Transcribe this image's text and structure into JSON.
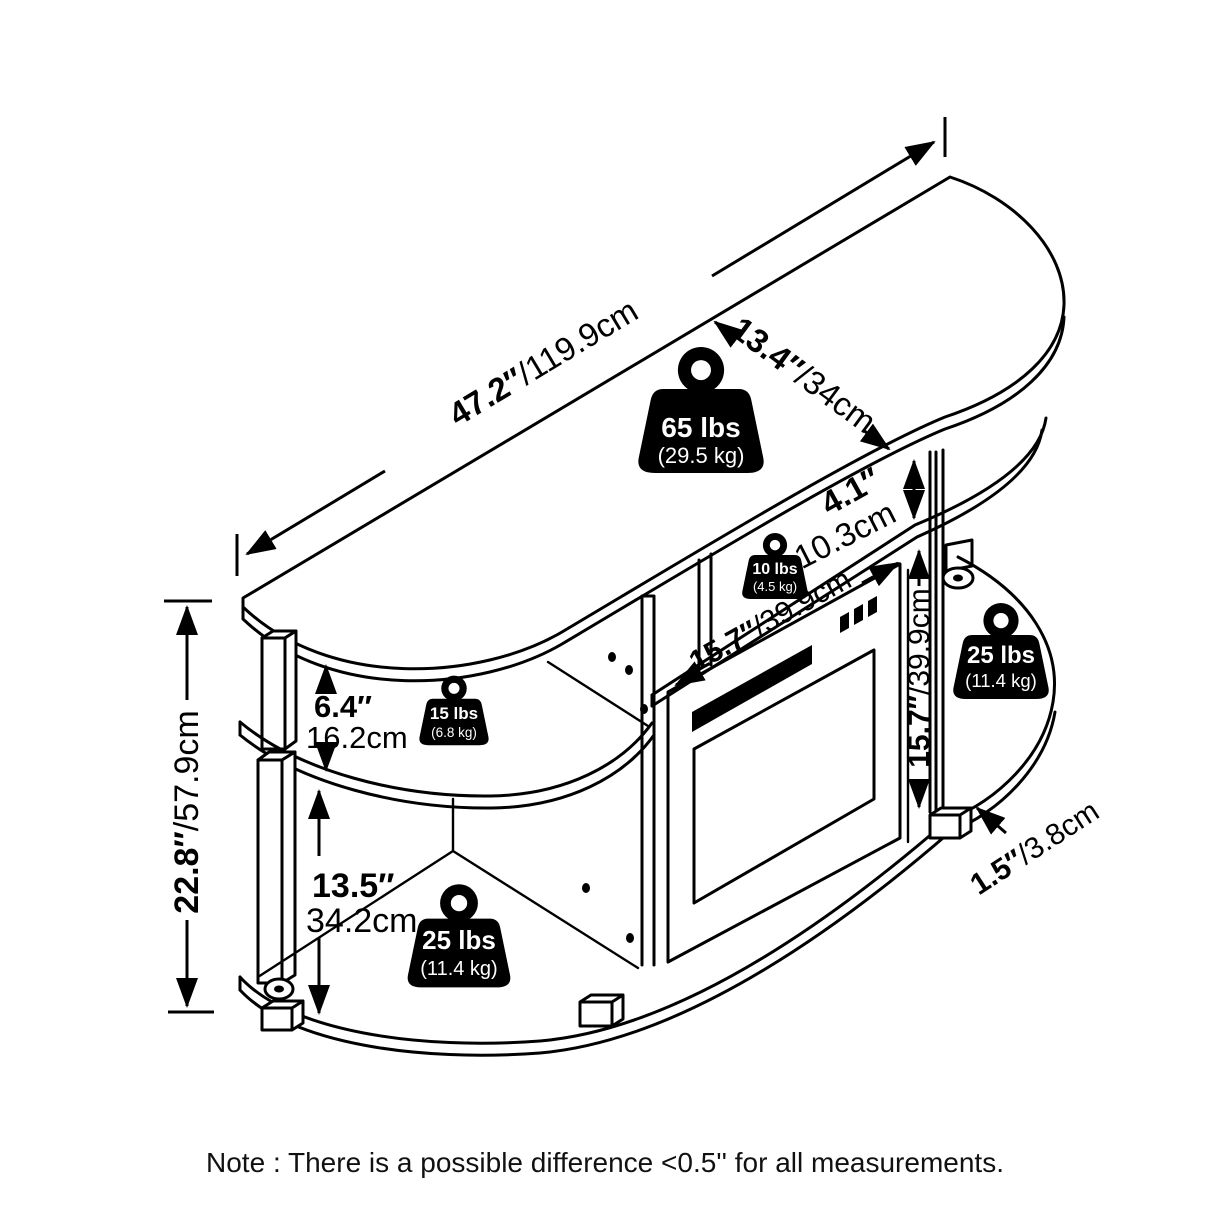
{
  "dims": {
    "width": {
      "in": "47.2″",
      "cm": "/119.9cm"
    },
    "depth": {
      "in": "13.4″",
      "cm": "/34cm"
    },
    "gap": {
      "in": "4.1″",
      "cm": "10.3cm"
    },
    "fp_w": {
      "in": "15.7″",
      "cm": "/39.9cm"
    },
    "fp_h": {
      "in": "15.7″",
      "cm": "/39.9cm"
    },
    "upper": {
      "in": "6.4″",
      "cm": "16.2cm"
    },
    "lower": {
      "in": "13.5″",
      "cm": "34.2cm"
    },
    "height": {
      "in": "22.8″",
      "cm": "/57.9cm"
    },
    "leg": {
      "in": "1.5″",
      "cm": "/3.8cm"
    }
  },
  "weights": {
    "top": {
      "lbs": "65 lbs",
      "kg": "(29.5 kg)"
    },
    "mid": {
      "lbs": "10 lbs",
      "kg": "(4.5 kg)"
    },
    "upper_left": {
      "lbs": "15 lbs",
      "kg": "(6.8 kg)"
    },
    "right": {
      "lbs": "25 lbs",
      "kg": "(11.4 kg)"
    },
    "lower_left": {
      "lbs": "25 lbs",
      "kg": "(11.4 kg)"
    }
  },
  "note": "Note : There is a possible difference <0.5'' for all measurements.",
  "colors": {
    "line": "#000000",
    "background": "#ffffff",
    "badge": "#000000",
    "badge_text": "#ffffff"
  }
}
